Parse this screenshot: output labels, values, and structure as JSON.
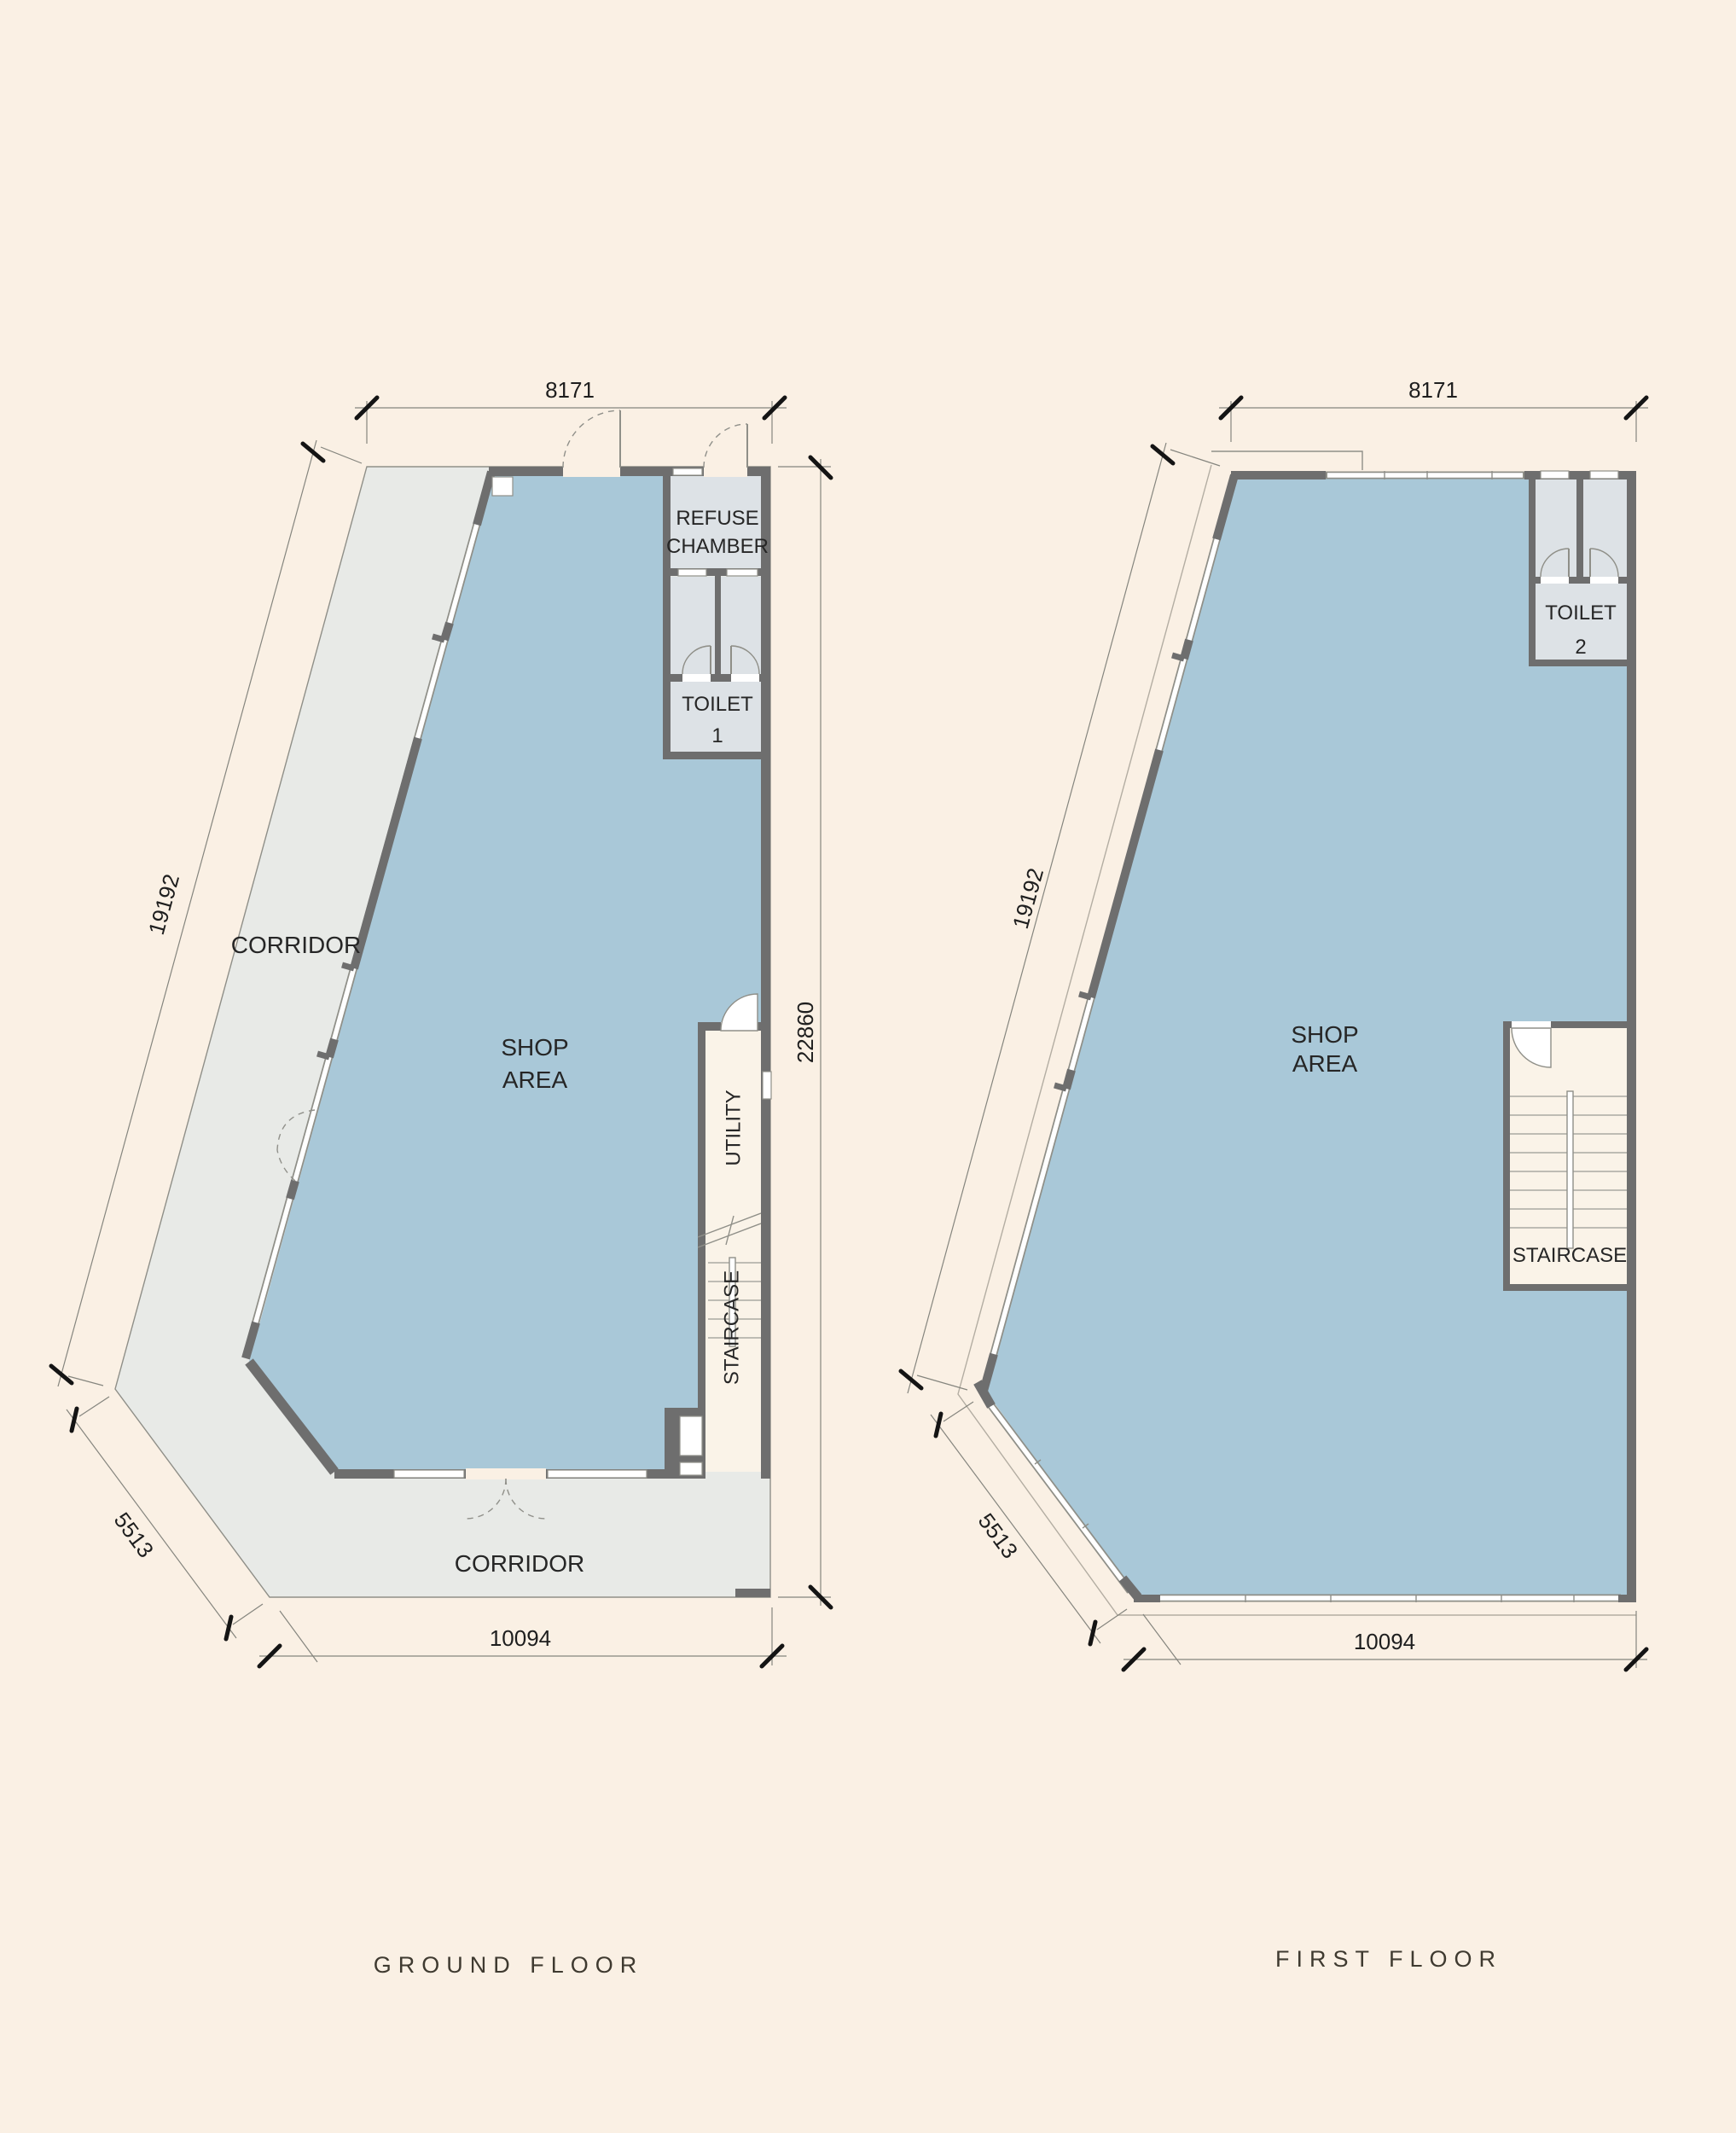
{
  "colors": {
    "background": "#faf0e4",
    "shop_fill": "#a9c8d8",
    "corridor_fill": "#e8eae7",
    "room_fill": "#dde2e6",
    "stair_fill": "#faf3e8",
    "wall": "#6e6e6e",
    "line": "#8f8f88",
    "white": "#ffffff",
    "dim_text": "#1e1e1e",
    "label_text": "#262626",
    "title_text": "#3f3a30"
  },
  "ground_floor": {
    "title": "GROUND FLOOR",
    "labels": {
      "shop_line1": "SHOP",
      "shop_line2": "AREA",
      "corridor_left": "CORRIDOR",
      "corridor_bottom": "CORRIDOR",
      "refuse_line1": "REFUSE",
      "refuse_line2": "CHAMBER",
      "toilet_line1": "TOILET",
      "toilet_number": "1",
      "utility": "UTILITY",
      "staircase": "STAIRCASE"
    },
    "dimensions": {
      "top": "8171",
      "left": "19192",
      "right": "22860",
      "diagonal": "5513",
      "bottom": "10094"
    }
  },
  "first_floor": {
    "title": "FIRST FLOOR",
    "labels": {
      "shop_line1": "SHOP",
      "shop_line2": "AREA",
      "toilet_line1": "TOILET",
      "toilet_number": "2",
      "staircase": "STAIRCASE"
    },
    "dimensions": {
      "top": "8171",
      "left": "19192",
      "diagonal": "5513",
      "bottom": "10094"
    }
  }
}
